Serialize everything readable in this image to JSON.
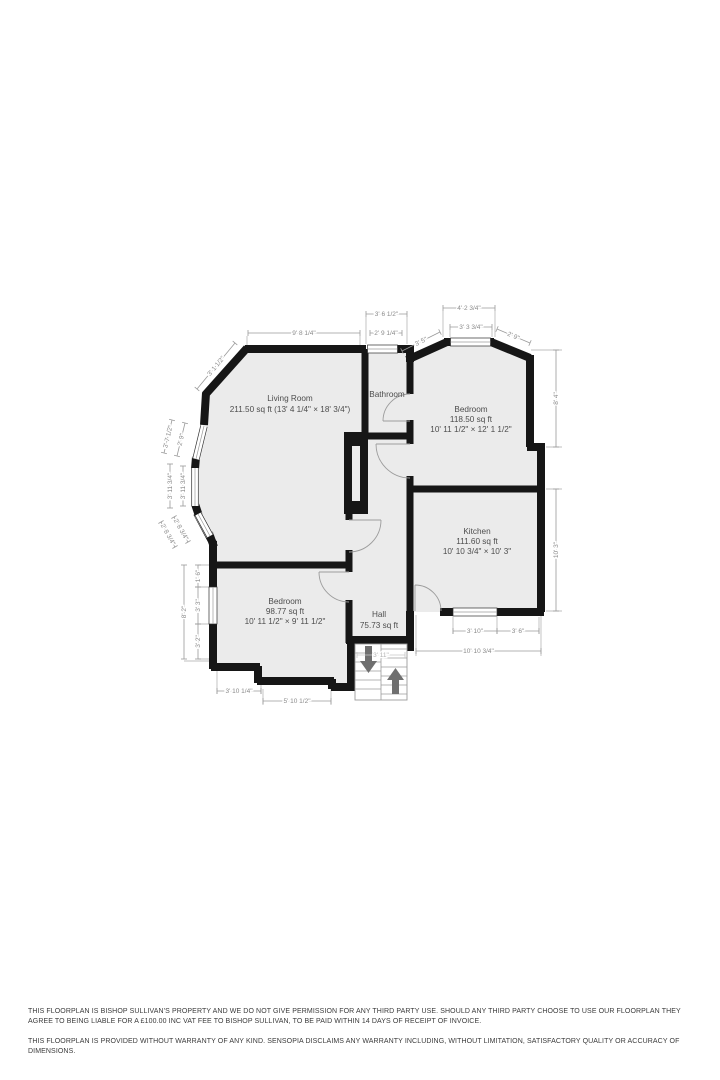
{
  "page": {
    "background": "#ffffff"
  },
  "floorplan": {
    "colors": {
      "wall": "#161616",
      "floor_fill": "#ebebeb",
      "dimension_line": "#9a9a9a",
      "dimension_text": "#8a8a8a",
      "room_text": "#4d4d4d",
      "stairs_arrow": "#6f6f6f"
    },
    "rooms": {
      "living": {
        "name": "Living Room",
        "line2": "211.50 sq ft (13' 4 1/4\" × 18' 3/4\")"
      },
      "bathroom": {
        "name": "Bathroom"
      },
      "bedroom1": {
        "name": "Bedroom",
        "area": "118.50 sq ft",
        "size": "10' 11 1/2\" × 12' 1 1/2\""
      },
      "kitchen": {
        "name": "Kitchen",
        "area": "111.60 sq ft",
        "size": "10' 10 3/4\" × 10' 3\""
      },
      "bedroom2": {
        "name": "Bedroom",
        "area": "98.77 sq ft",
        "size": "10' 11 1/2\" × 9' 11 1/2\""
      },
      "hall": {
        "name": "Hall",
        "area": "75.73 sq ft"
      }
    },
    "dims": [
      {
        "t": "9' 8 1/4\"",
        "x1": 248,
        "y1": 333,
        "x2": 360,
        "y2": 333
      },
      {
        "t": "3' 6 1/2\"",
        "x1": 366,
        "y1": 314,
        "x2": 407,
        "y2": 314
      },
      {
        "t": "2' 9 1/4\"",
        "x1": 370,
        "y1": 333,
        "x2": 402,
        "y2": 333
      },
      {
        "t": "3' 5\"",
        "x1": 402,
        "y1": 351,
        "x2": 440,
        "y2": 332
      },
      {
        "t": "4' 2 3/4\"",
        "x1": 443,
        "y1": 308,
        "x2": 495,
        "y2": 308
      },
      {
        "t": "3' 3 3/4\"",
        "x1": 450,
        "y1": 327,
        "x2": 492,
        "y2": 327
      },
      {
        "t": "2' 9\"",
        "x1": 497,
        "y1": 329,
        "x2": 530,
        "y2": 343
      },
      {
        "t": "8' 4\"",
        "x1": 556,
        "y1": 447,
        "x2": 556,
        "y2": 350
      },
      {
        "t": "10' 3\"",
        "x1": 556,
        "y1": 611,
        "x2": 556,
        "y2": 489
      },
      {
        "t": "3' 10\"",
        "x1": 453,
        "y1": 631,
        "x2": 497,
        "y2": 631
      },
      {
        "t": "3' 6\"",
        "x1": 497,
        "y1": 631,
        "x2": 539,
        "y2": 631
      },
      {
        "t": "10' 10 3/4\"",
        "x1": 416,
        "y1": 651,
        "x2": 541,
        "y2": 651
      },
      {
        "t": "3' 10 1/4\"",
        "x1": 217,
        "y1": 691,
        "x2": 261,
        "y2": 691
      },
      {
        "t": "5' 10 1/2\"",
        "x1": 263,
        "y1": 701,
        "x2": 331,
        "y2": 701
      },
      {
        "t": "3' 11\"",
        "x1": 357,
        "y1": 655,
        "x2": 405,
        "y2": 655,
        "faint": true
      },
      {
        "t": "3' 1 1/2\"",
        "x1": 197,
        "y1": 389,
        "x2": 235,
        "y2": 343
      },
      {
        "t": "3' 7 1/2\"",
        "x1": 164,
        "y1": 453,
        "x2": 172,
        "y2": 420
      },
      {
        "t": "2' 9\"",
        "x1": 177,
        "y1": 456,
        "x2": 185,
        "y2": 423
      },
      {
        "t": "3' 11 3/4\"",
        "x1": 170,
        "y1": 508,
        "x2": 170,
        "y2": 464
      },
      {
        "t": "3' 11 3/4\"",
        "x1": 183,
        "y1": 506,
        "x2": 183,
        "y2": 466
      },
      {
        "t": "2' 8 3/4\"",
        "x1": 161,
        "y1": 522,
        "x2": 175,
        "y2": 547
      },
      {
        "t": "2' 8 3/4\"",
        "x1": 174,
        "y1": 517,
        "x2": 188,
        "y2": 542
      },
      {
        "t": "8' 2\"",
        "x1": 184,
        "y1": 659,
        "x2": 184,
        "y2": 565
      },
      {
        "t": "1' 6\"",
        "x1": 198,
        "y1": 587,
        "x2": 198,
        "y2": 565
      },
      {
        "t": "3' 3\"",
        "x1": 198,
        "y1": 624,
        "x2": 198,
        "y2": 587
      },
      {
        "t": "3' 2\"",
        "x1": 198,
        "y1": 659,
        "x2": 198,
        "y2": 624
      }
    ]
  },
  "footer": {
    "line1": "THIS FLOORPLAN IS BISHOP SULLIVAN'S PROPERTY AND WE DO NOT GIVE PERMISSION FOR ANY THIRD PARTY USE. SHOULD ANY THIRD PARTY CHOOSE TO USE OUR FLOORPLAN THEY AGREE TO BEING LIABLE FOR A £100.00 INC VAT FEE TO BISHOP SULLIVAN, TO BE PAID WITHIN 14 DAYS OF RECEIPT OF INVOICE.",
    "line2": "THIS FLOORPLAN IS PROVIDED WITHOUT WARRANTY OF ANY KIND. SENSOPIA DISCLAIMS ANY WARRANTY INCLUDING, WITHOUT LIMITATION, SATISFACTORY QUALITY OR ACCURACY OF DIMENSIONS."
  }
}
